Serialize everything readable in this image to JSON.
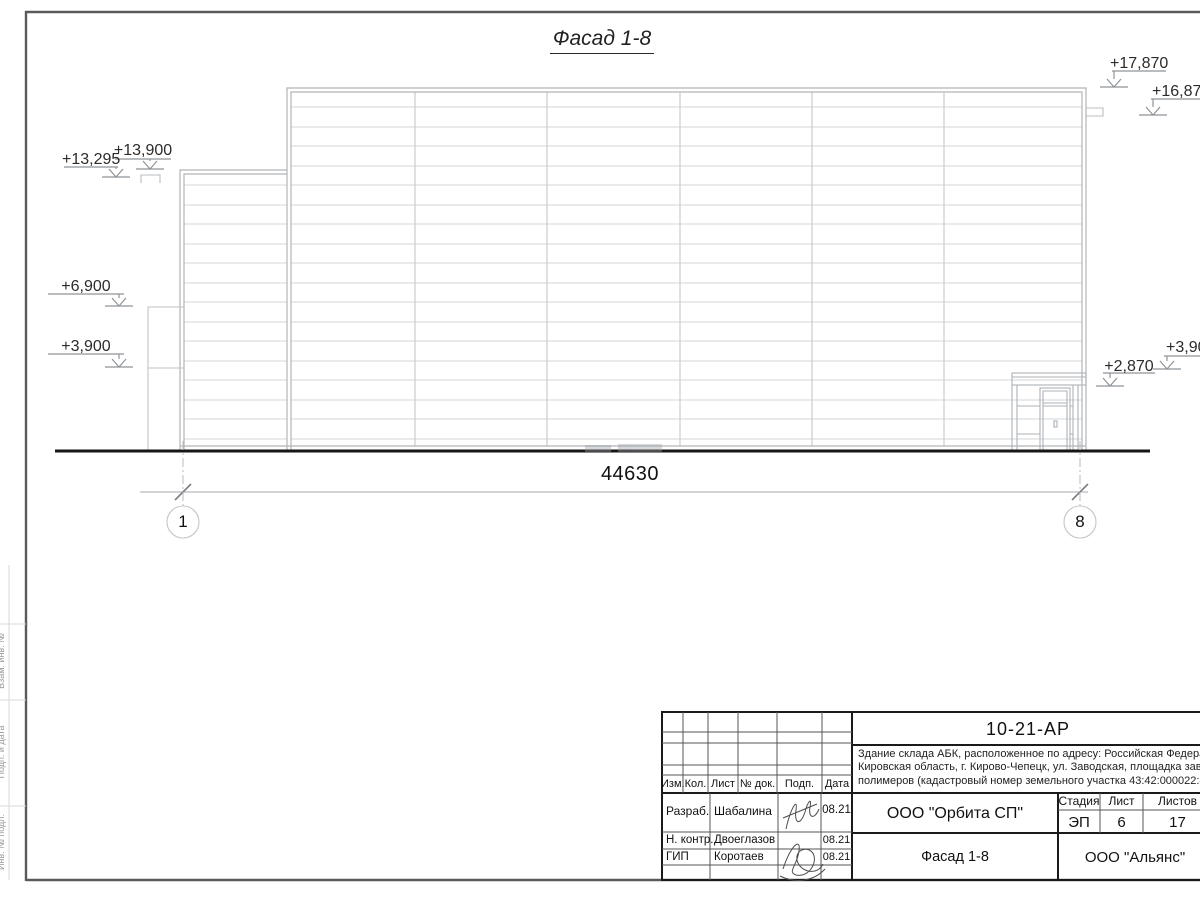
{
  "drawing": {
    "title": "Фасад 1-8",
    "dimension_total": "44630",
    "axis_left": "1",
    "axis_right": "8",
    "marks": {
      "top_main": "+17,870",
      "top_right": "+16,870",
      "left_roof": "+13,900",
      "left_scupper": "+13,295",
      "left_annex": "+6,900",
      "left_mid": "+3,900",
      "right_mid": "+3,900",
      "right_canopy": "+2,870"
    }
  },
  "title_block": {
    "doc_number": "10-21-АР",
    "description_lines": [
      "Здание склада АБК, расположенное по адресу: Российская Федерация,",
      "Кировская область, г. Кирово-Чепецк, ул. Заводская, площадка завода",
      "полимеров (кадастровый номер земельного участка 43:42:000022:43)"
    ],
    "header_columns": [
      "Изм.",
      "Кол.",
      "Лист",
      "№ док.",
      "Подп.",
      "Дата"
    ],
    "roles": [
      {
        "role": "Разраб.",
        "name": "Шабалина",
        "date": "08.21"
      },
      {
        "role": "Н. контр.",
        "name": "Двоеглазов",
        "date": "08.21"
      },
      {
        "role": "ГИП",
        "name": "Коротаев",
        "date": "08.21"
      }
    ],
    "company": "ООО \"Орбита СП\"",
    "sheet_title": "Фасад 1-8",
    "contractor": "ООО \"Альянс\"",
    "stage_headers": [
      "Стадия",
      "Лист",
      "Листов"
    ],
    "stage_values": [
      "ЭП",
      "6",
      "17"
    ]
  },
  "margin_labels": [
    "Взам. инв. №",
    "Подп. и дата",
    "Инв. № подл."
  ]
}
